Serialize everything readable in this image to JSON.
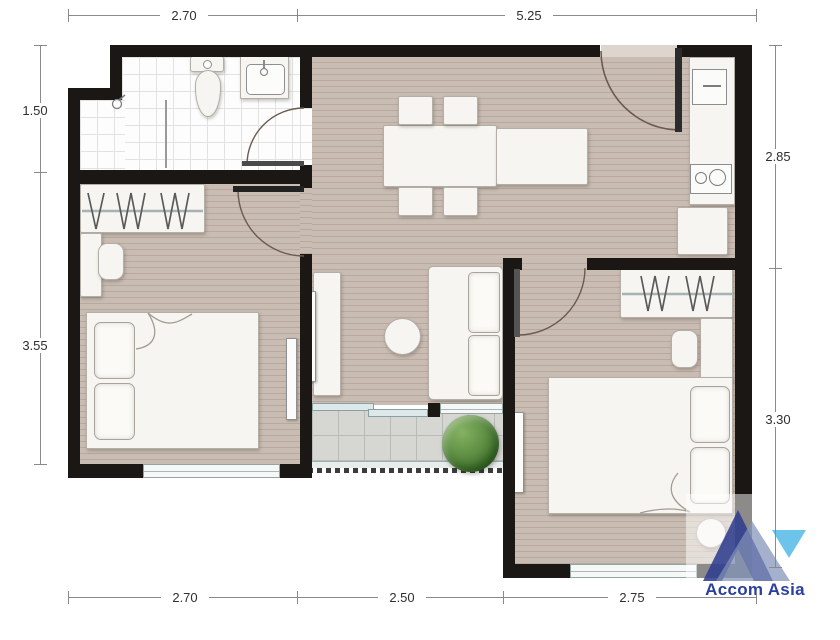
{
  "dimensions": {
    "top": [
      {
        "label": "2.70"
      },
      {
        "label": "5.25"
      }
    ],
    "left": [
      {
        "label": "1.50"
      },
      {
        "label": "3.55"
      }
    ],
    "right": [
      {
        "label": "2.85"
      },
      {
        "label": "3.30"
      }
    ],
    "bottom": [
      {
        "label": "2.70"
      },
      {
        "label": "2.50"
      },
      {
        "label": "2.75"
      }
    ]
  },
  "logo": {
    "text": "Accom Asia"
  },
  "colors": {
    "wall": "#1a1715",
    "floor": "#c9bcb3",
    "floor_stripe": "#b7a99f",
    "bath_tile": "#fdfdfd",
    "bath_grid": "#e2e2e0",
    "balcony_tile": "#d6d7d3",
    "balcony_grid": "#b9bbb7",
    "furniture": "#f6f5f1",
    "furniture_border": "#b3aea6",
    "plant_green": "#4e7d39",
    "logo_navy": "#2e3c8f",
    "logo_slate": "#8292b8",
    "logo_cyan": "#6cc4ea",
    "logo_text": "#2b3f9e",
    "dim_line": "#8a8a8a",
    "dim_text": "#2f2f2f"
  }
}
